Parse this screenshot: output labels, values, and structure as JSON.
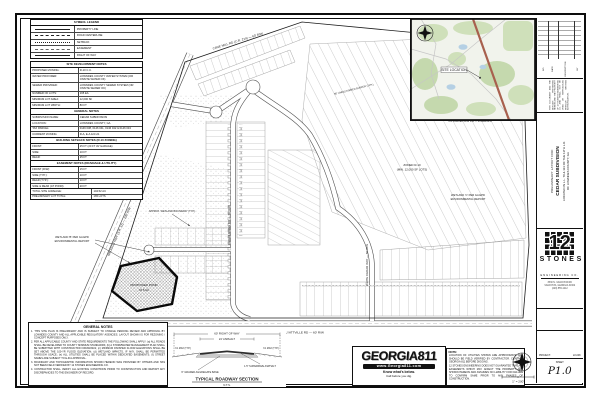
{
  "legend": {
    "title": "SYMBOL LEGEND",
    "rows": [
      {
        "label": "PROPERTY LINE"
      },
      {
        "label": "ROAD CENTERLINE"
      },
      {
        "label": "SETBACK"
      },
      {
        "label": "EASEMENT"
      },
      {
        "label": "RIGHT OF WAY"
      }
    ]
  },
  "site_dev": {
    "title": "SITE DEVELOPMENT NOTES",
    "rows": [
      {
        "label": "PROPOSED ZONING:",
        "value": "R-10 C.U."
      },
      {
        "label": "WATER PROVIDER:",
        "value": "LOWNDES COUNTY WATER SYSTEM (OR ONSITE WATER OK)"
      },
      {
        "label": "SEWER PROVIDER:",
        "value": "LOWNDES COUNTY SEWER SYSTEM (OR ONSITE SEWER OK)"
      },
      {
        "label": "NUMBER OF LOTS:",
        "value": "165 EA"
      },
      {
        "label": "MINIMUM LOT AREA:",
        "value": "12,000 SF"
      },
      {
        "label": "MINIMUM LOT WIDTH:",
        "value": "80 FT"
      },
      {
        "label": "MAX. IMPERVIOUS SURFACE:",
        "value": "35%"
      }
    ]
  },
  "project_info": {
    "title": "GENERAL NOTES",
    "rows": [
      {
        "label": "SUBDIVISION NAME:",
        "value": "CEDAR SUBDIVISION"
      },
      {
        "label": "LOCATION:",
        "value": "LOWNDES COUNTY, GA"
      },
      {
        "label": "TAX PARCEL:",
        "value": "0146 038, 0146 041, 0146 042 & 0146 043"
      },
      {
        "label": "CURRENT ZONING:",
        "value": "R-A, E-A & R-21"
      }
    ]
  },
  "setbacks": {
    "title": "BUILDING SETBACK NOTES (R-10 ZONING)",
    "rows": [
      {
        "label": "FRONT:",
        "value": "25 FT (20 FT W/ GARAGE)"
      },
      {
        "label": "SIDE:",
        "value": "10 FT"
      },
      {
        "label": "REAR:",
        "value": "25 FT"
      }
    ]
  },
  "easements": {
    "title": "EASEMENT NOTES (DRAINAGE & UTILITY)",
    "rows": [
      {
        "label": "FRONT (R/W):",
        "value": "15 FT"
      },
      {
        "label": "SIDE (TYP.):",
        "value": "10 FT"
      },
      {
        "label": "REAR (TYP.):",
        "value": "10 FT"
      },
      {
        "label": "SIDE & REAR (AT POND):",
        "value": "20 FT"
      }
    ]
  },
  "totals": {
    "rows": [
      {
        "label": "TOTAL SITE ACREAGE:",
        "value": "104.52 AC"
      },
      {
        "label": "PRELIMINARY LOT TOTAL:",
        "value": "165 LOTS"
      }
    ]
  },
  "general_notes": {
    "title": "GENERAL NOTES",
    "items": [
      "1.  THIS SITE PLAN IS PRELIMINARY AND IS SUBJECT TO CHANGE PENDING REVIEW AND APPROVAL BY LOWNDES COUNTY AND ALL APPLICABLE REGULATORY AGENCIES. LAYOUT SHOWN IS FOR REZONING / CONCEPT PURPOSES ONLY.",
      "2.  PER ALL APPLICABLE COUNTY AND STATE REQUIREMENTS THE FOLLOWING SHALL APPLY: (a) ALL ROADS SHALL BE DEVELOPED TO COUNTY MINIMUM STANDARDS; (b) A STORMWATER MANAGEMENT PLAN SHALL BE SUBMITTED WITH CONSTRUCTION DRAWINGS; (c) MINIMUM FINISHED FLOOR ELEVATIONS SHALL BE SET ABOVE THE 100-YR FLOOD ELEVATION; (d) WETLAND IMPACTS, IF ANY, SHALL BE PERMITTED THROUGH USACE; (e) ALL UTILITIES SHALL BE PLACED WITHIN DEDICATED EASEMENTS; (f) STREET NAMES ARE SUBJECT TO E-911 APPROVAL.",
      "3.  BOUNDARY AND TOPOGRAPHIC INFORMATION SHOWN HEREON WAS PROVIDED BY OTHERS AND HAS NOT BEEN FIELD VERIFIED BY 12 STONES ENGINEERING CO.",
      "4.  CONTRACTOR SHALL VERIFY ALL EXISTING CONDITIONS PRIOR TO CONSTRUCTION AND REPORT ANY DISCREPANCIES TO THE ENGINEER OF RECORD."
    ]
  },
  "roadway_section": {
    "dim_row": "60' RIGHT OF WAY",
    "dim_asphalt": "24' ASPHALT",
    "slope_left": "3:1 MAX (TYP.)",
    "slope_right": "3:1 MAX (TYP.)",
    "label_asphalt": "1.5\" SUPERPAVE ASPHALT",
    "label_base": "6\" GRADED AGGREGATE BASE",
    "title": "TYPICAL ROADWAY SECTION",
    "scale": "N.T.S."
  },
  "georgia811": {
    "name": "GEORGIA811",
    "website": "www.Georgia811.com",
    "tagline1": "Know what's below.",
    "tagline2": "Call before you dig."
  },
  "utility_note": {
    "heading": "NOTE:",
    "p1": "LOCATION OF UTILITIES SHOWN ARE APPROXIMATE AND SHOULD BE FIELD VERIFIED BY CONTRACTOR. CONTACT GEORGIA 811 BEFORE DIGGING.",
    "p2": "12 STONES ENGINEERING DOES NOT GUARANTEE THAT ALL EASEMENTS WHICH MAY AFFECT THE PROPERTY ARE SHOWN HEREON AND ASSUMES NO LIABILITY FOR FAILURE TO CONFIRM SAME PRIOR TO ANY PHASES OF CONSTRUCTION."
  },
  "vicinity": {
    "site_label": "SITE LOCATION"
  },
  "scale_bar": {
    "label": "1\" = 200'"
  },
  "title_block": {
    "rev_headers": [
      "NO.",
      "DATE",
      "DESCRIPTION",
      "BY"
    ],
    "disclaimer": "THIS DOCUMENT AND THE DESIGNS PRESENTED HEREIN ARE THE PROPERTY OF 12 STONES ENGINEERING CO. AND SHALL NOT BE USED OR REPRODUCED WITHOUT WRITTEN AUTHORIZATION.",
    "project_for": "PRELIMINARY LAYOUT FOR:",
    "project_name": "CEDAR SUBDIVISION",
    "project_loc1": "LOCATED IN L.L. 70 & 113 OF THE 11TH L.D.",
    "project_loc2": "OF LOWNDES COUNTY, GA",
    "firm_numeral": "12",
    "firm_name": "STONES",
    "firm_tag": "ENGINEERING CO.",
    "firm_addr1": "3530 N. VALDOSTA RD",
    "firm_addr2": "VALDOSTA, GEORGIA 31602",
    "firm_addr3": "(229) 555-1212",
    "project_label": "PROJECT:",
    "project_value": "22-048",
    "sheet_label": "SHEET",
    "sheet_value": "P1.0"
  },
  "plan": {
    "labels": [
      {
        "text": "MADISON HWY (S.R. 31) — 100' R/W",
        "x": 120,
        "y": 232,
        "r": -66,
        "fs": 3.1
      },
      {
        "text": "CANE MILL RD (C.R. 214) — 60' R/W",
        "x": 238,
        "y": 42,
        "r": -17,
        "fs": 3.1
      },
      {
        "text": "OLD CLYATTVILLE RD — 60' R/W",
        "x": 300,
        "y": 333.5,
        "r": 0,
        "fs": 3.1
      },
      {
        "text": "CEDAR RIDGE DR — 60' R/W",
        "x": 230,
        "y": 225,
        "r": -90,
        "fs": 2.9
      },
      {
        "text": "WHITE CEDAR WAY — 60' R/W",
        "x": 368,
        "y": 265,
        "r": -90,
        "fs": 2.9
      },
      {
        "text": "WETLAND AND CONSERVATION",
        "x": 458,
        "y": 70,
        "r": 0,
        "fs": 2.9
      },
      {
        "text": "EASEMENT AREA (TYP.)",
        "x": 458,
        "y": 74.5,
        "r": 0,
        "fs": 2.9
      },
      {
        "text": "ZONED R-10",
        "x": 412,
        "y": 166,
        "r": 0,
        "fs": 2.9
      },
      {
        "text": "(MIN. 12,000 SF LOTS)",
        "x": 412,
        "y": 170.5,
        "r": 0,
        "fs": 2.9
      },
      {
        "text": "WETLAND 'C' PER GA EPD",
        "x": 468,
        "y": 196,
        "r": 0,
        "fs": 2.7
      },
      {
        "text": "ENVIRONMENTAL REPORT",
        "x": 468,
        "y": 200.2,
        "r": 0,
        "fs": 2.7
      },
      {
        "text": "WETLAND 'B' PER GA EPD",
        "x": 72,
        "y": 238,
        "r": 0,
        "fs": 2.7
      },
      {
        "text": "ENVIRONMENTAL REPORT",
        "x": 72,
        "y": 242.2,
        "r": 0,
        "fs": 2.7
      },
      {
        "text": "PROPOSED POND",
        "x": 144,
        "y": 286,
        "r": 0,
        "fs": 3.1
      },
      {
        "text": "±6.5 AC",
        "x": 144,
        "y": 291,
        "r": 0,
        "fs": 2.9
      },
      {
        "text": "APPROX. WETLAND BOUNDARY (TYP.)",
        "x": 172,
        "y": 212,
        "r": 0,
        "fs": 2.5
      },
      {
        "text": "N/F PARCEL 0146 043 — ZONED E-A",
        "x": 470,
        "y": 122,
        "r": 0,
        "fs": 2.5
      },
      {
        "text": "50' UNDISTURBED BUFFER (TYP.)",
        "x": 354,
        "y": 90,
        "r": -14,
        "fs": 2.5
      }
    ]
  }
}
